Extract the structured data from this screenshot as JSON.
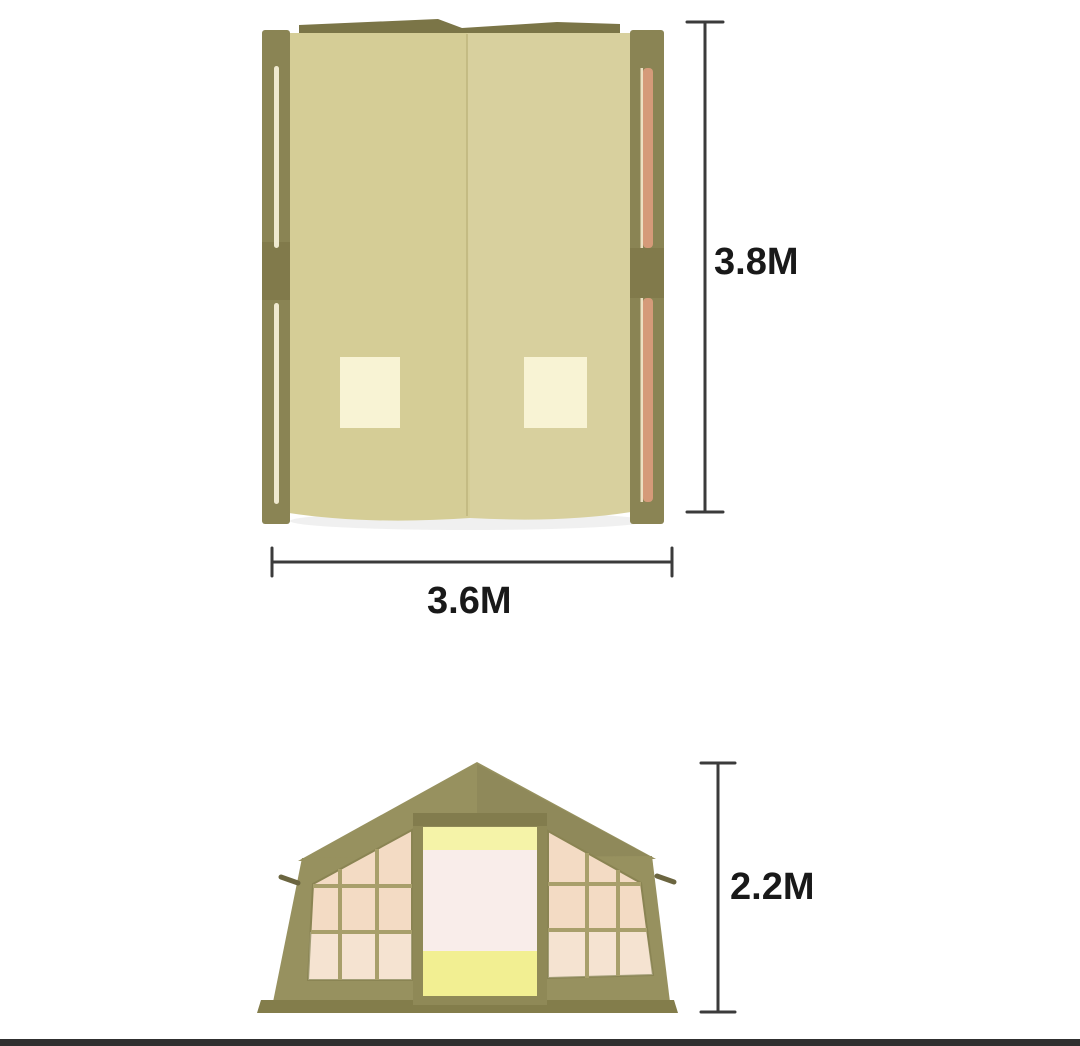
{
  "page": {
    "background_color": "#ffffff",
    "footer_bar_color": "#303030"
  },
  "diagram": {
    "subject": "Inflatable cabin tent dimension diagram (top view and front view)",
    "top_view": {
      "height_label": "3.8M",
      "width_label": "3.6M"
    },
    "front_view": {
      "height_label": "2.2M"
    },
    "colors": {
      "tent_olive": "#97915f",
      "rail_olive": "#8a8454",
      "ridge_olive": "#7b7547",
      "canvas_beige": "#d5cd96",
      "skylight_cream": "#f8f3d4",
      "air_pole_salmon": "#d59a79",
      "window_pane": "#f3dbc4",
      "door_top_yellow": "#f5f3a8",
      "door_panel_pink": "#f9edea",
      "door_bottom_yellow": "#f2ef92",
      "dimension_line": "#3b3b3b",
      "label_text": "#191919"
    }
  }
}
